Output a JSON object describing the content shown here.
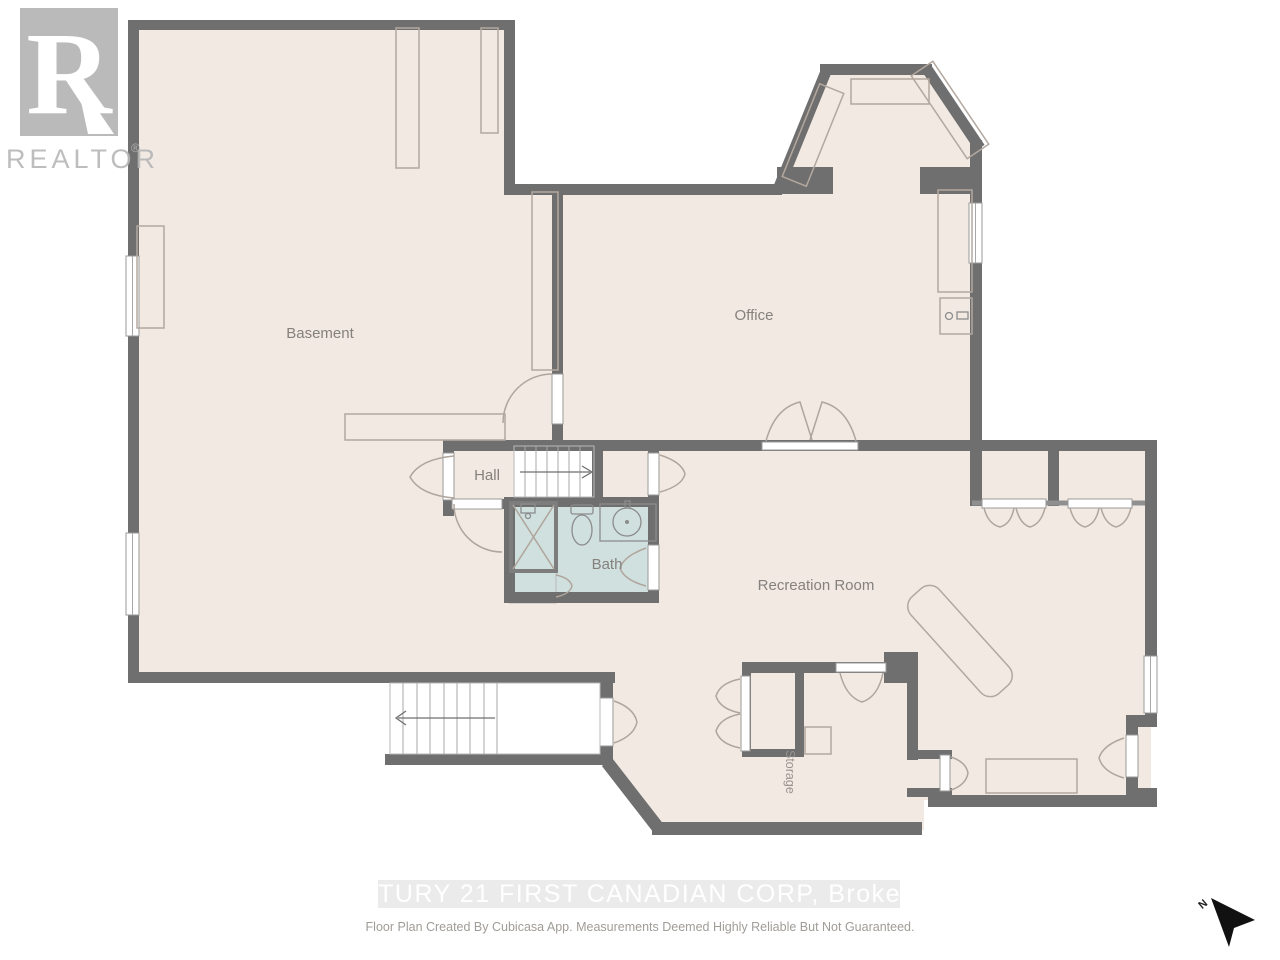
{
  "branding": {
    "logo_letter": "R",
    "logo_text": "REALTOR",
    "logo_reg": "®"
  },
  "rooms": {
    "basement": {
      "label": "Basement"
    },
    "office": {
      "label": "Office"
    },
    "hall": {
      "label": "Hall"
    },
    "bath": {
      "label": "Bath"
    },
    "recreation": {
      "label": "Recreation Room"
    },
    "storage": {
      "label": "Storage"
    }
  },
  "fixtures": [
    "shower-icon",
    "toilet-icon",
    "sink-icon",
    "stairs-up-icon",
    "stairs-down-icon"
  ],
  "compass": {
    "north_label": "N"
  },
  "footer": {
    "watermark": "CENTURY 21 FIRST CANADIAN CORP, Brokerage",
    "disclaimer": "Floor Plan Created By Cubicasa App. Measurements Deemed Highly Reliable But Not Guaranteed."
  },
  "colors": {
    "wall": "#6f6f6f",
    "floor": "#f2e9e3",
    "bath_floor": "#cfe0de",
    "logo_gray": "#b5b5b5",
    "label_text": "#85817d",
    "watermark_band": "#e8e8e8",
    "watermark_text": "#ffffff",
    "disclaimer_text": "#a09c98",
    "north_arrow": "#111111"
  }
}
